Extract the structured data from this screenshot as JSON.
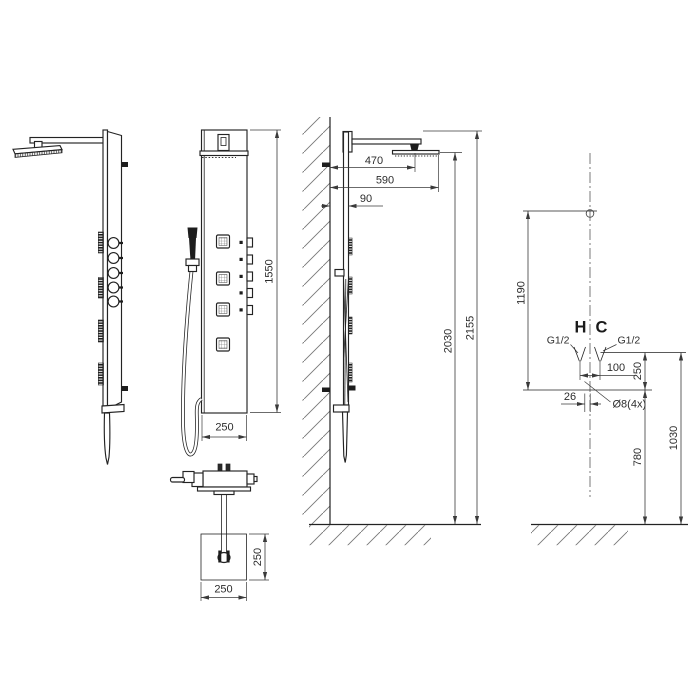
{
  "colors": {
    "background": "#ffffff",
    "object_line": "#232323",
    "dimension_line": "#3a3a3a",
    "text": "#2d2d2d"
  },
  "front_view": {
    "panel_height": "1550",
    "panel_width": "250"
  },
  "spout_detail": {
    "plate_depth": "250",
    "plate_width": "250"
  },
  "side_view": {
    "head_center_offset": "470",
    "head_edge_offset": "590",
    "panel_depth": "90",
    "panel_top_height": "2030",
    "overall_height": "2155"
  },
  "installation": {
    "upper_span": "1190",
    "hot_label": "H",
    "cold_label": "C",
    "thread_left": "G1/2",
    "thread_right": "G1/2",
    "outlet_spacing": "100",
    "outlet_to_bracket": "250",
    "bracket_offset": "26",
    "holes_label": "Ø8(4x)",
    "lower_span": "780",
    "bracket_level_height": "1030"
  }
}
